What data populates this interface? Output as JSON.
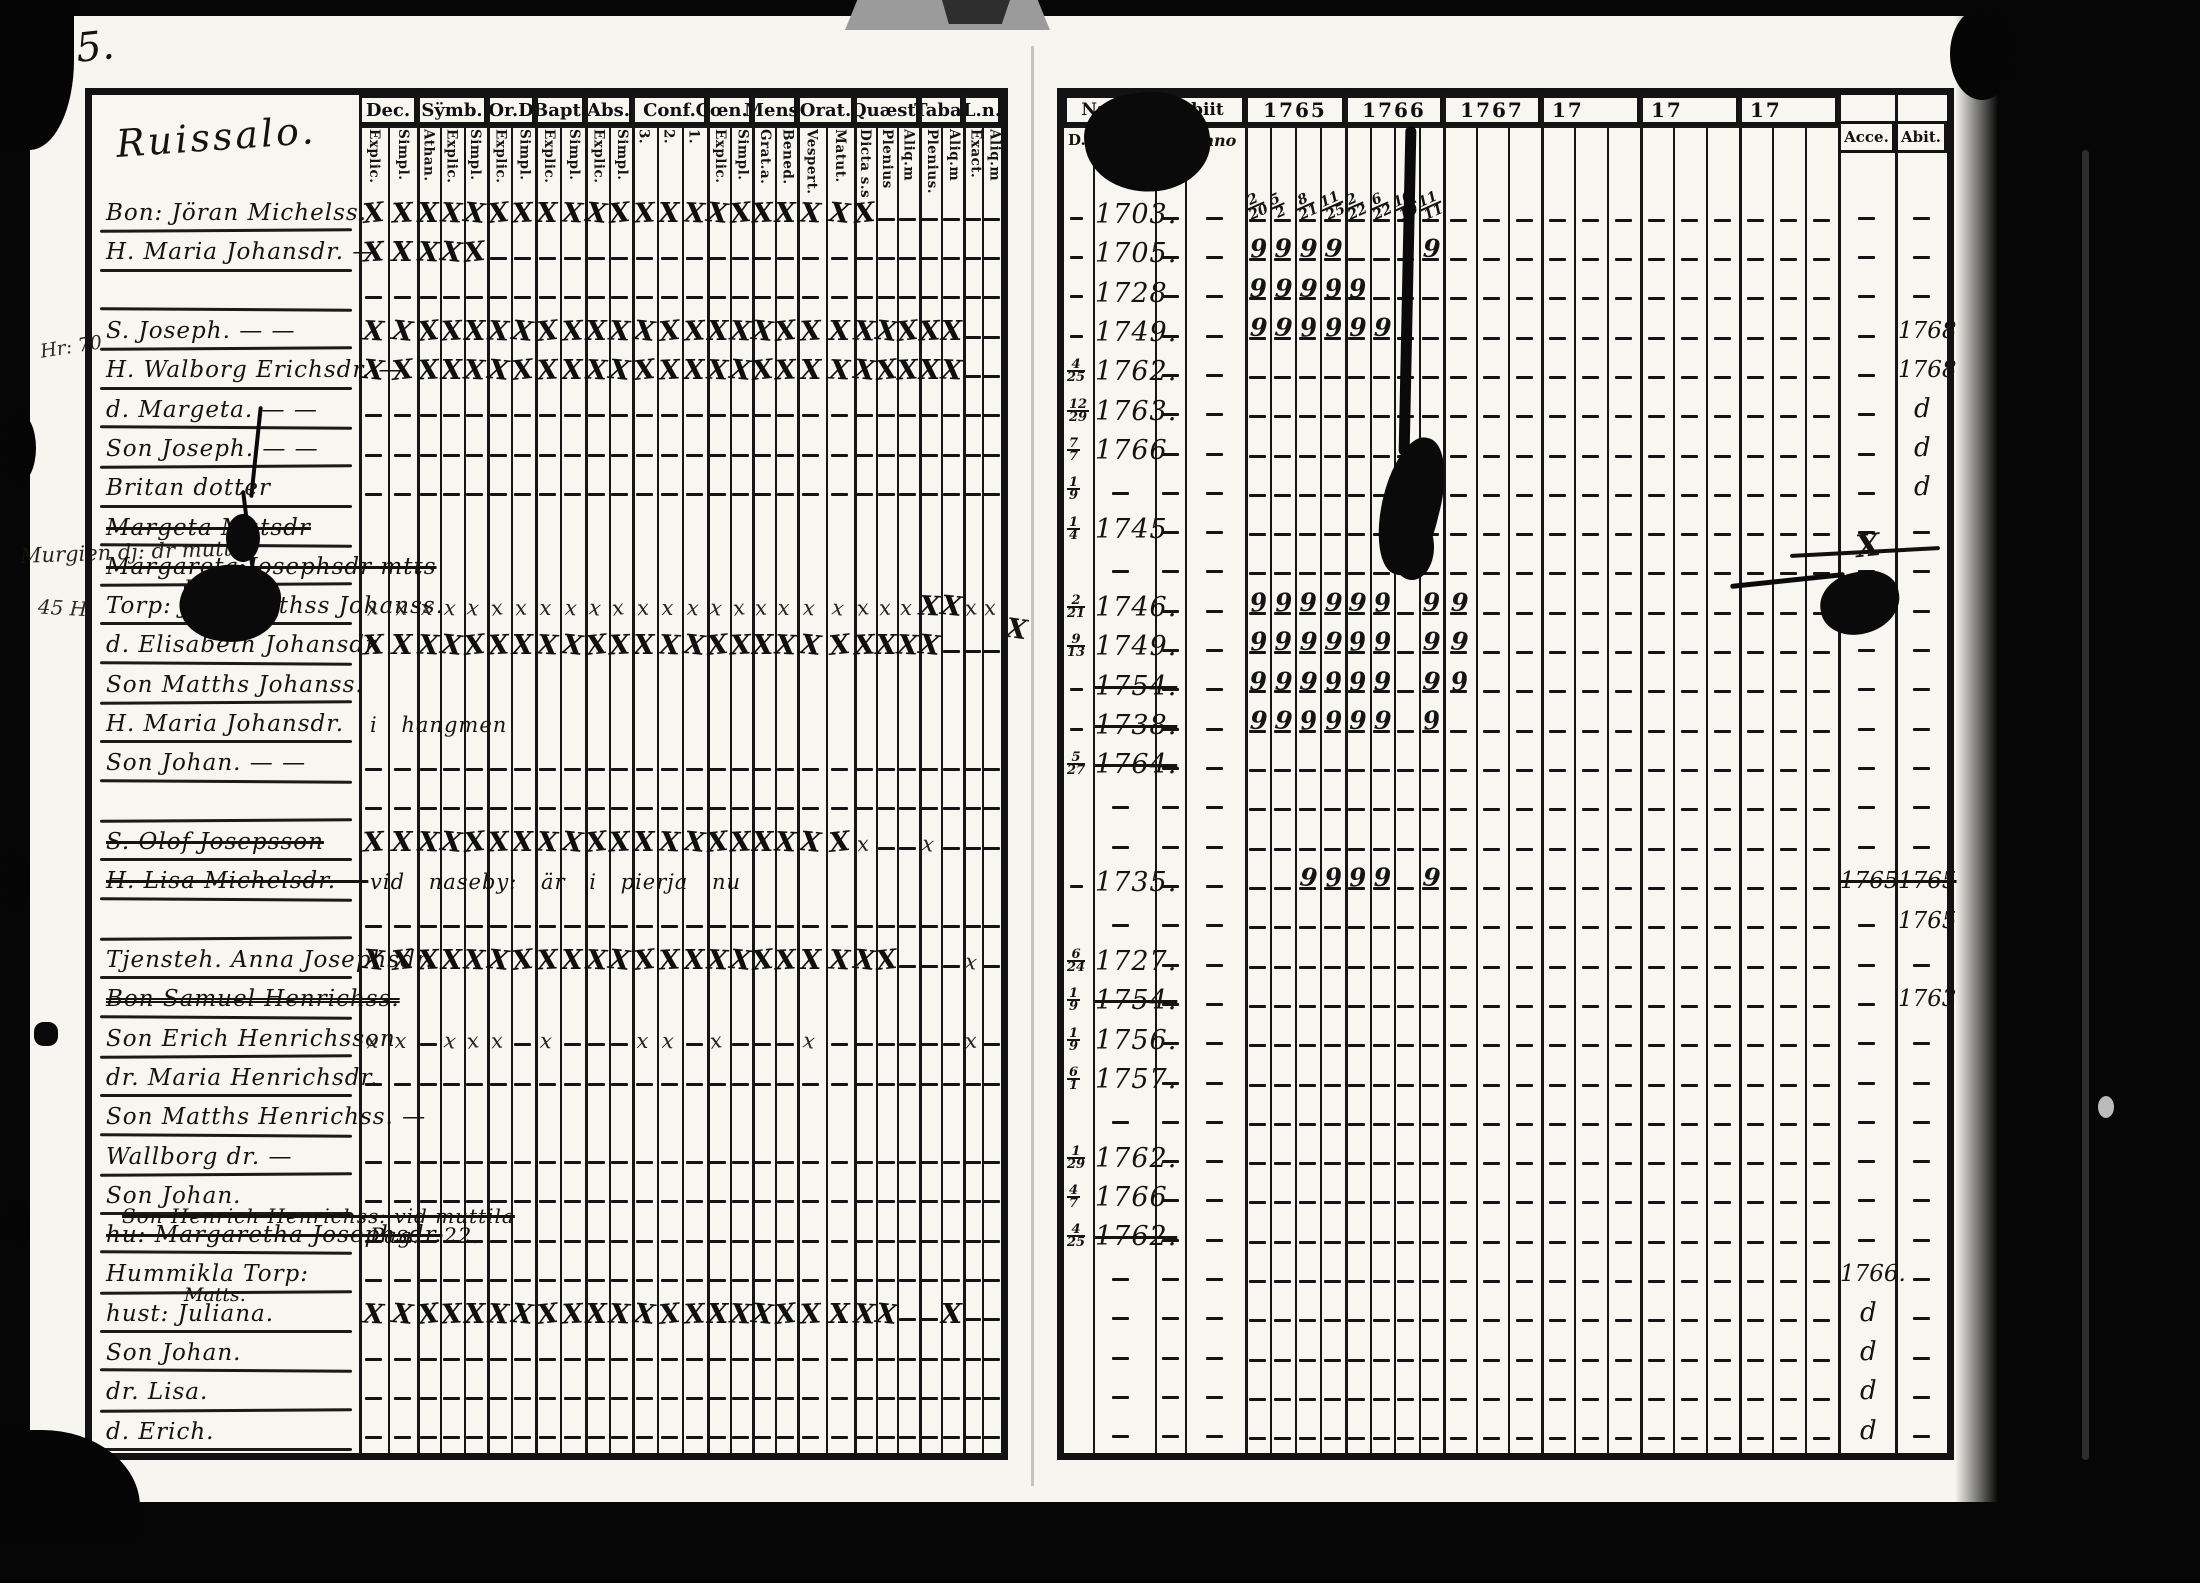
{
  "page_number": "5.",
  "left_page": {
    "title": "Ruissalo.",
    "columns": [
      {
        "label": "Dec.",
        "subs": [
          "Explic.",
          "Simpl."
        ]
      },
      {
        "label": "Sÿmb.",
        "subs": [
          "Athan.",
          "Explic.",
          "Simpl."
        ]
      },
      {
        "label": "Or.D",
        "subs": [
          "Explic.",
          "Simpl."
        ]
      },
      {
        "label": "Bapt.",
        "subs": [
          "Explic.",
          "Simpl."
        ]
      },
      {
        "label": "Abs.",
        "subs": [
          "Explic.",
          "Simpl."
        ]
      },
      {
        "label": "Conf.",
        "subs": [
          "3.",
          "2.",
          "1."
        ]
      },
      {
        "label": "Cœn.D",
        "subs": [
          "Explic.",
          "Simpl."
        ]
      },
      {
        "label": "Mens.",
        "subs": [
          "Grat.a.",
          "Bened."
        ]
      },
      {
        "label": "Orat.",
        "subs": [
          "Vespert.",
          "Matut."
        ]
      },
      {
        "label": "Quæst.",
        "subs": [
          "Dicta s.s",
          "Plenius",
          "Aliq.m"
        ]
      },
      {
        "label": "Taba.",
        "subs": [
          "Plenius.",
          "Aliq.m"
        ]
      },
      {
        "label": "L.n.",
        "subs": [
          "Exact.",
          "Aliq.m"
        ]
      }
    ],
    "rows": [
      {
        "name": "Bon: Jöran Michelss.",
        "marks": "XXXXXXXXXXXXXXXXXXXXX------"
      },
      {
        "name": "H. Maria Johansdr. —",
        "marks": "XXXXX----------------------"
      },
      {
        "name": "",
        "marks": "---------------------------"
      },
      {
        "name": "S. Joseph. —  —",
        "marks": "XXXXXXXXXXXXXXXXXXXXXXXXX--"
      },
      {
        "name": "H. Walborg Erichsdr. —",
        "marks": "XXXXXXXXXXXXXXXXXXXXXXXXX--"
      },
      {
        "name": "d. Margeta. —  —",
        "marks": "---------------------------"
      },
      {
        "name": "Son Joseph. —  —",
        "marks": "---------------------------"
      },
      {
        "name": "Britan dotter",
        "marks": "---------------------------"
      },
      {
        "name": "Margeta Matsdr",
        "struck": true,
        "marks": "..........................."
      },
      {
        "name": "Margareta Josephsdr mtts",
        "struck": true,
        "sub": "Faldin",
        "sub_struck": true,
        "marks": "..........................."
      },
      {
        "name": "Torp: Jan Matthss Johanss.",
        "marks": "xxxxxxxxxxxxxxxxxxxxxxxXXxx"
      },
      {
        "name": "d. Elisabeth Johansdr.",
        "marks": "XXXXXXXXXXXXXXXXXXXXXXXX---"
      },
      {
        "name": "Son Matths Johanss.",
        "marks": "..........................."
      },
      {
        "name": "H. Maria Johansdr.",
        "note": "i hangmen",
        "marks": "..........................."
      },
      {
        "name": "Son Johan. —  —",
        "marks": "---------------------------"
      },
      {
        "name": "",
        "marks": "---------------------------"
      },
      {
        "name": "S. Olof Josepsson",
        "struck": true,
        "marks": "XXXXXXXXXXXXXXXXXXXXx--x---"
      },
      {
        "name": "H. Lisa Michelsdr. —",
        "struck": true,
        "note": "vid naseby: är i pierja nu",
        "marks": "..........................."
      },
      {
        "name": "",
        "marks": "---------------------------"
      },
      {
        "name": "Tjensteh. Anna Josephsdr.",
        "marks": "XXXXXXXXXXXXXXXXXXXXXX---x-"
      },
      {
        "name": "Bon Samuel Henrichss.",
        "struck": true,
        "double_struck": true,
        "marks": "..........................."
      },
      {
        "name": "Son Erich Henrichsson",
        "marks": "xx-xxx-x---xx-x---x------x-"
      },
      {
        "name": "dr. Maria Henrichsdr.",
        "marks": "---------------------------"
      },
      {
        "name": "Son Matths Henrichss. —",
        "marks": "..........................."
      },
      {
        "name": "Wallborg dr. —",
        "marks": "---------------------------"
      },
      {
        "name": "Son Johan.",
        "struck_note": "Son Henrich Henrichss: vid muttila",
        "marks": "---------------------------"
      },
      {
        "name": "hu: Margaretha Josephsdr.",
        "struck": true,
        "note": "Pag. 22.",
        "marks": "---------------------------"
      },
      {
        "name": "Hummikla Torp:",
        "sub": "Matts.",
        "marks": "---------------------------"
      },
      {
        "name": "hust: Juliana.",
        "marks": "XXXXXXXXXXXXXXXXXXXXXX--X--"
      },
      {
        "name": "Son Johan.",
        "marks": "---------------------------"
      },
      {
        "name": "dr. Lisa.",
        "marks": "---------------------------"
      },
      {
        "name": "d. Erich.",
        "marks": "---------------------------"
      }
    ]
  },
  "right_page": {
    "natus_label": "Natus",
    "obiit_label": "Obiit",
    "d_label": "D.",
    "anno_label": "Anno",
    "years": [
      {
        "label": "1765",
        "subcols": 4
      },
      {
        "label": "1766",
        "subcols": 4
      },
      {
        "label": "1767",
        "subcols": 3
      },
      {
        "label": "17",
        "subcols": 3
      },
      {
        "label": "17",
        "subcols": 3
      },
      {
        "label": "17",
        "subcols": 3
      }
    ],
    "accessit_label": "Acce.",
    "abiit_label": "Abit.",
    "communion_dates": [
      "2/20",
      "5/2",
      "8/21",
      "11/25",
      "2/22",
      "6/22",
      "10/19",
      "11/11"
    ],
    "rows": [
      {
        "anno": "1703."
      },
      {
        "anno": "1705.",
        "nines": [
          0,
          1,
          2,
          3,
          7
        ]
      },
      {
        "anno": "1728",
        "nines": [
          0,
          1,
          2,
          3,
          4
        ]
      },
      {
        "anno": "1749.",
        "nines": [
          0,
          1,
          2,
          3,
          4,
          5
        ],
        "abi": "1768"
      },
      {
        "d": "4/25",
        "anno": "1762.",
        "abi": "1768"
      },
      {
        "d": "12/29",
        "anno": "1763.",
        "abi": "d"
      },
      {
        "d": "7/7",
        "anno": "1766",
        "abi": "d"
      },
      {
        "d": "1/9",
        "abi": "d"
      },
      {
        "d": "1/4",
        "anno": "1745"
      },
      {},
      {
        "d": "2/21",
        "anno": "1746.",
        "nines": [
          0,
          1,
          2,
          3,
          4,
          5,
          7,
          8
        ]
      },
      {
        "d": "9/13",
        "anno": "1749.",
        "nines": [
          0,
          1,
          2,
          3,
          4,
          5,
          7,
          8
        ]
      },
      {
        "anno": "1754.",
        "struck": true,
        "nines": [
          0,
          1,
          2,
          3,
          4,
          5,
          7,
          8
        ]
      },
      {
        "anno": "1738.",
        "struck": true,
        "nines": [
          0,
          1,
          2,
          3,
          4,
          5,
          7
        ]
      },
      {
        "d": "5/27",
        "anno": "1764.",
        "struck": true
      },
      {},
      {},
      {
        "anno": "1735.",
        "nines": [
          2,
          3,
          4,
          5,
          7
        ],
        "acc": "1765",
        "acc_struck": true,
        "abi": "1765",
        "abi_struck": true
      },
      {
        "abi": "1765"
      },
      {
        "d": "6/24",
        "anno": "1727."
      },
      {
        "d": "1/9",
        "anno": "1754.",
        "struck": true,
        "abi": "1763"
      },
      {
        "d": "1/9",
        "anno": "1756."
      },
      {
        "d": "6/1",
        "anno": "1757."
      },
      {},
      {
        "d": "1/29",
        "anno": "1762."
      },
      {
        "d": "4/7",
        "anno": "1766"
      },
      {
        "d": "4/25",
        "anno": "1762.",
        "struck": true
      },
      {
        "acc": "1766."
      },
      {
        "acc": "d"
      },
      {
        "acc": "d"
      },
      {
        "acc": "d"
      },
      {
        "acc": "d"
      }
    ]
  },
  "marginalia": {
    "left_note_1": "Hr: 70",
    "left_note_2": "Murgien dj: dr mutts",
    "left_note_3": "45 H.",
    "stray_x": "X",
    "accessit_scribble": "X"
  }
}
